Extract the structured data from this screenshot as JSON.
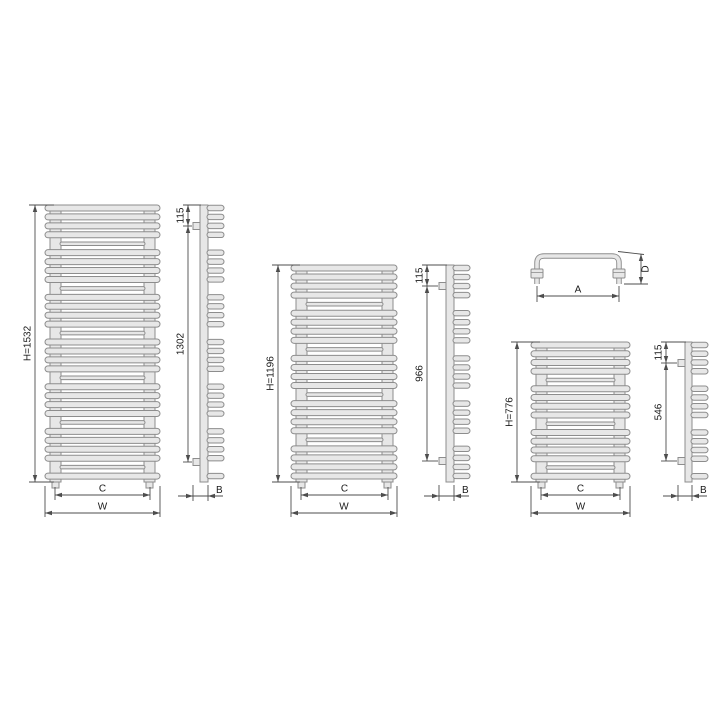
{
  "drawing": {
    "background": "#ffffff",
    "outline_color": "#8d8d8d",
    "fill_color": "#e7e7e7",
    "dimension_color": "#4d4d4d",
    "text_color": "#1a1a1a",
    "radiators": [
      {
        "name": "tall",
        "height_label": "H=1532",
        "bracket_offset_label": "115",
        "bracket_span_label": "1302",
        "depth_label": "B",
        "collector_width_label": "C",
        "overall_width_label": "W",
        "tube_rows": 31,
        "tube_group_size": 4
      },
      {
        "name": "medium",
        "height_label": "H=1196",
        "bracket_offset_label": "115",
        "bracket_span_label": "966",
        "depth_label": "B",
        "collector_width_label": "C",
        "overall_width_label": "W",
        "tube_rows": 24,
        "tube_group_size": 4
      },
      {
        "name": "short",
        "height_label": "H=776",
        "bracket_offset_label": "115",
        "bracket_span_label": "546",
        "depth_label": "B",
        "collector_width_label": "C",
        "overall_width_label": "W",
        "tube_rows": 16,
        "tube_group_size": 4
      }
    ],
    "handle_detail": {
      "width_label": "A",
      "depth_label": "D"
    }
  }
}
